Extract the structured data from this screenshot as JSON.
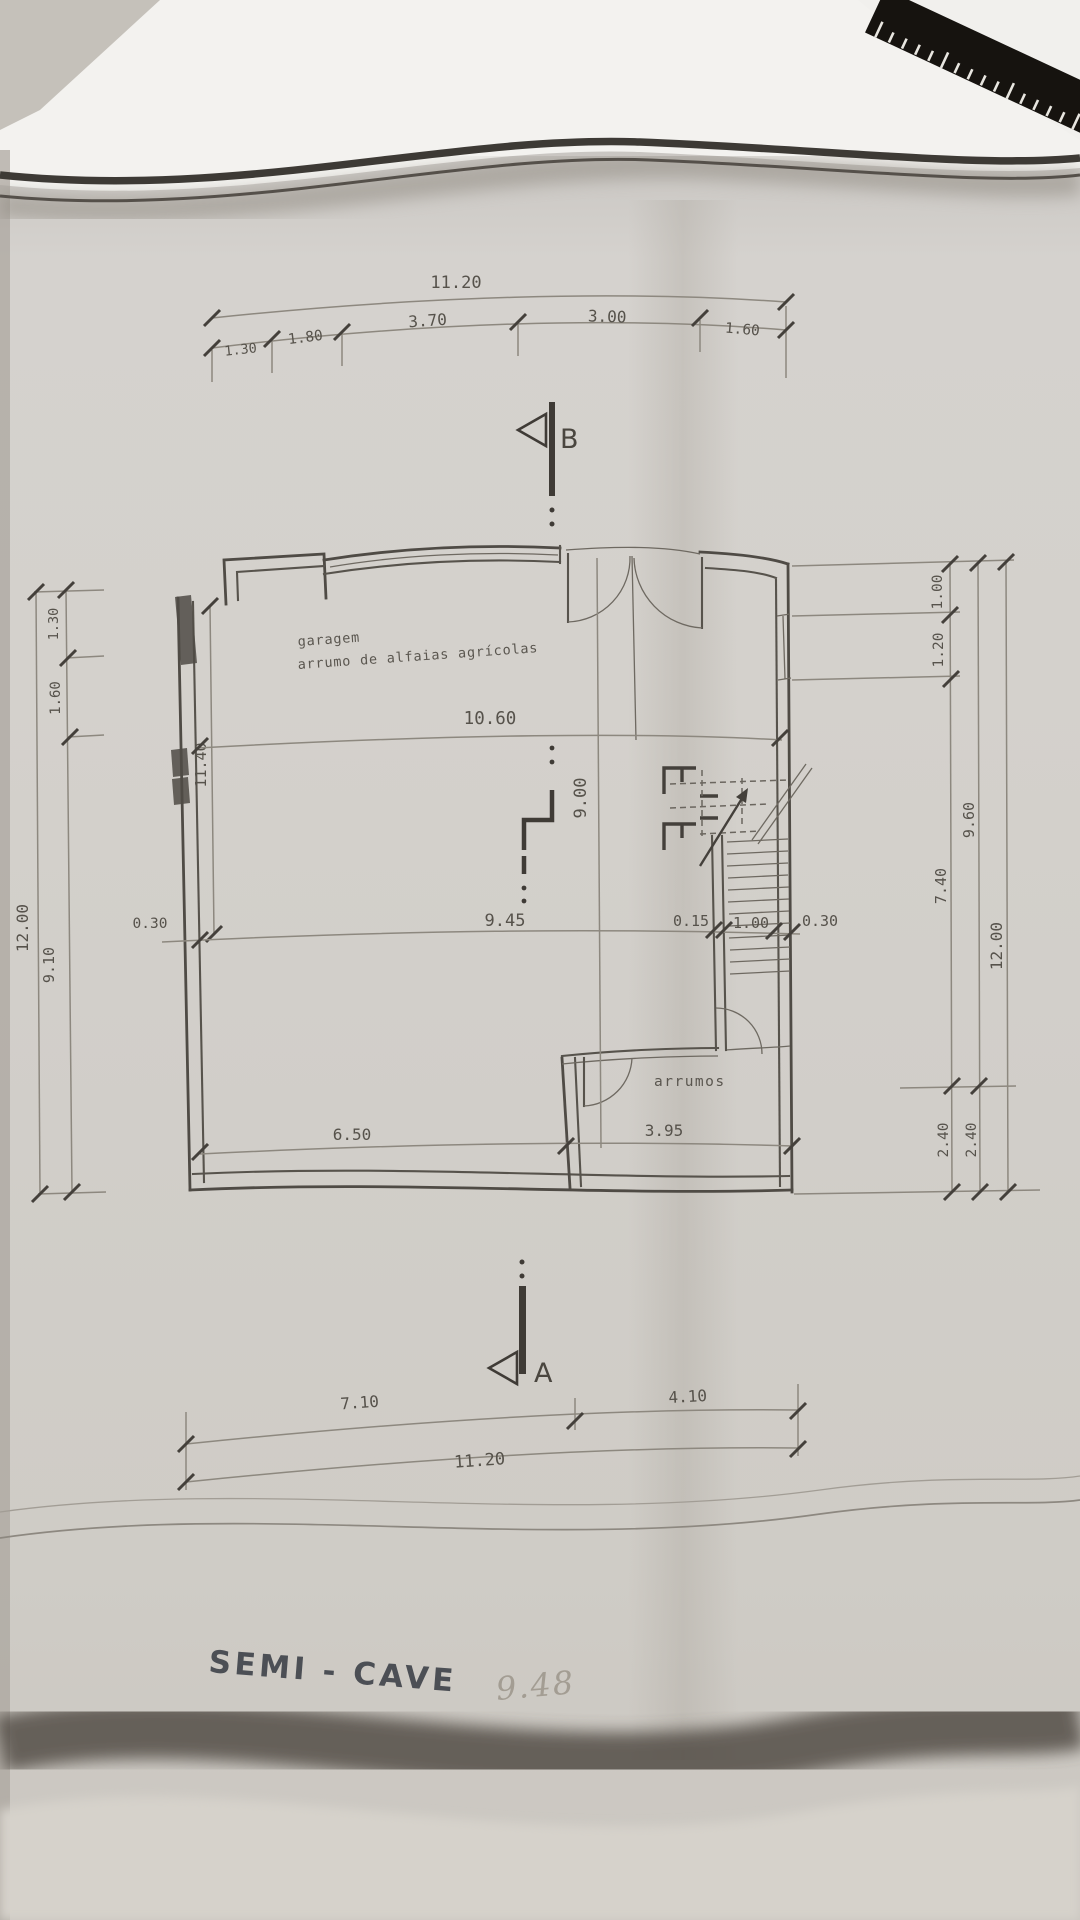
{
  "document": {
    "kind": "architectural floor plan photo",
    "title": "SEMI - CAVE",
    "handwritten_note": "9.48"
  },
  "plan": {
    "rooms": {
      "garage": {
        "line1": "garagem",
        "line2": "arrumo de alfaias agrícolas"
      },
      "storage": {
        "label": "arrumos"
      }
    },
    "section_markers": {
      "top": "B",
      "bottom": "A"
    },
    "dimensions": {
      "top": {
        "overall": "11.20",
        "segments": [
          "1.30",
          "1.80",
          "3.70",
          "3.00",
          "1.60"
        ]
      },
      "left": {
        "overall": "12.00",
        "segments": [
          "1.30",
          "1.60",
          "9.10"
        ],
        "interior_height": "11.40",
        "wall_thickness": "0.30"
      },
      "interior": {
        "width_upper": "10.60",
        "height_mid": "9.00",
        "width_mid": "9.45",
        "stair_wall": "0.15",
        "stair_width": "1.00",
        "right_wall": "0.30",
        "width_lower_left": "6.50",
        "width_lower_right": "3.95"
      },
      "right": {
        "overall": "12.00",
        "upper_segments": [
          "1.00",
          "1.20",
          "7.40"
        ],
        "subtotal": "9.60",
        "lower_segments": [
          "2.40",
          "2.40"
        ]
      },
      "bottom": {
        "overall": "11.20",
        "segments": [
          "7.10",
          "4.10"
        ]
      }
    }
  },
  "colors": {
    "ink": "#4f4b45",
    "thin_line": "#8d887f",
    "paper": "#d2cfca",
    "table": "#b7b2ab",
    "title_ink": "#4c4f55",
    "pencil": "#a39d93",
    "ruler_black": "#16130f"
  }
}
